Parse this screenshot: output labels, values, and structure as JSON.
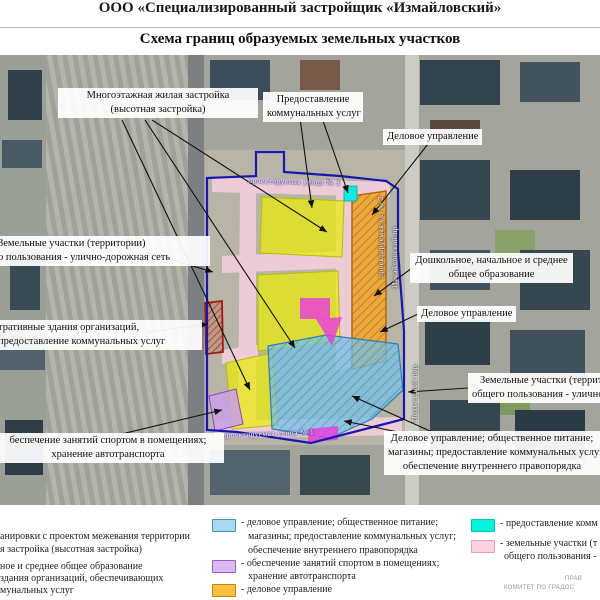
{
  "header": {
    "org": "ООО «Специализированный  застройщик  «Измайловский»",
    "title": "Схема границ образуемых земельных участков"
  },
  "map": {
    "street_labels": {
      "top": "проектируемая улица № 3",
      "bottom": "проектируемая улица № 1",
      "vertical_1": "проектируемая ул. № 2",
      "vertical_2": "Измайловский пр.",
      "vertical_3": "Подъездной пер."
    },
    "callouts": {
      "vysotnaya": [
        "Многоэтажная жилая застройка",
        "(высотная застройка)"
      ],
      "kommunalnye": [
        "Предоставление",
        "коммунальных услуг"
      ],
      "delovoe_top": [
        "Деловое управление"
      ],
      "zem_left": [
        "Земельные участки (территории)",
        "о пользования - улично-дорожная сеть"
      ],
      "admin": [
        "тративные здания организаций,",
        "предоставление коммунальных услуг"
      ],
      "sport": [
        "беспечение занятий спортом в помещениях;",
        "хранение автотранспорта"
      ],
      "doshkolnoe": [
        "Дошкольное, начальное и среднее",
        "общее образование"
      ],
      "delovoe_right": [
        "Деловое управление"
      ],
      "zem_right": [
        "Земельные участки (террито",
        "общего пользования - улично-доро"
      ],
      "delovoe_bottom": [
        "Деловое управление; общественное питание;",
        "магазины; предоставление коммунальных услуг;",
        "обеспечение внутреннего правопорядка"
      ]
    }
  },
  "legend": {
    "left": [
      [
        "анировки с проектом межевания территории",
        "я застройка (высотная застройка)"
      ],
      [
        "ное и среднее общее образование",
        "здания организаций, обеспечивающих",
        "мунальных услуг"
      ]
    ],
    "mid": [
      {
        "swatch": "#a9d7ee",
        "lines": [
          "- деловое управление; общественное питание;",
          "магазины; предоставление коммунальных услуг;",
          "обеспечение внутреннего правопорядка"
        ]
      },
      {
        "swatch": "#dcb8f5",
        "lines": [
          "- обеспечение занятий спортом в помещениях;",
          "хранение автотранспорта"
        ]
      },
      {
        "swatch": "#f6c13e",
        "lines": [
          "- деловое управление"
        ]
      }
    ],
    "right": [
      {
        "swatch": "#00f5dc",
        "lines": [
          "- предоставление комм"
        ]
      },
      {
        "swatch": "#fad2e0",
        "lines": [
          "- земельные участки (т",
          "общего пользования -"
        ]
      }
    ]
  },
  "footer": {
    "line1": "ПРАВ",
    "line2": "КОМИТЕТ ПО ГРАДОС"
  },
  "colors": {
    "boundary": "#1818b0",
    "zone_yellow": "#e9ec0a",
    "zone_orange": "#f0a830",
    "zone_blue": "#74bfe6",
    "zone_magenta": "#ea3cdc",
    "zone_cyan": "#12eadf",
    "zone_purple": "#c9a0e8",
    "zone_red_outline": "#9e1c12",
    "road_pink": "#f3cedd"
  }
}
